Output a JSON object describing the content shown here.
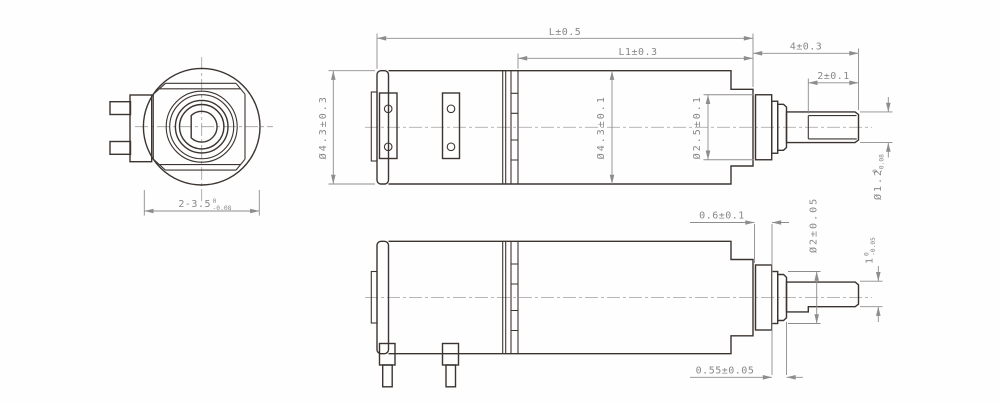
{
  "front_view": {
    "across_flats": {
      "value": "2-3.5",
      "tol_upper": "0",
      "tol_lower": "-0.08"
    }
  },
  "top_view": {
    "length_overall": "L±0.5",
    "length_motor_section": "L1±0.3",
    "shaft_extension": "4±0.3",
    "shaft_flat_length": "2±0.1",
    "gearbox_diameter": "Ø4.3±0.3",
    "motor_diameter": "Ø4.3±0.1",
    "boss_diameter": "Ø2.5±0.1",
    "shaft_diameter": {
      "value": "Ø1.2",
      "tol_upper": "0",
      "tol_lower": "-0.08"
    }
  },
  "bottom_view": {
    "boss_length": "0.6±0.1",
    "collar_diameter": "Ø2±0.05",
    "shaft_flat_height": {
      "value": "1",
      "tol_upper": "0",
      "tol_lower": "-0.05"
    },
    "collar_length": "0.55±0.05"
  },
  "colors": {
    "outline": "#3c3430",
    "dimension": "#8f8c8c",
    "centerline": "#a09d9d",
    "background": "#ffffff"
  }
}
